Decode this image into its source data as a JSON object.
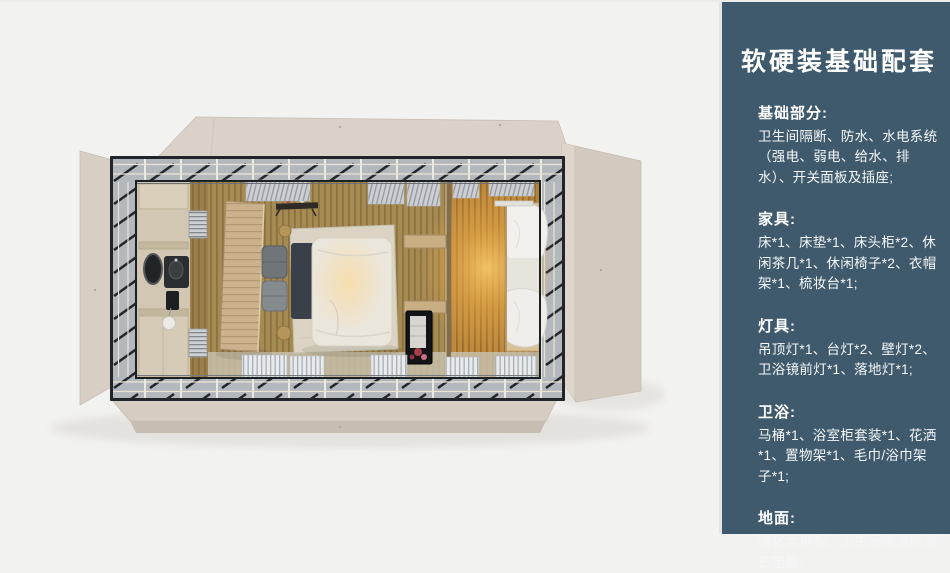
{
  "panel": {
    "title": "软硬装基础配套",
    "sections": [
      {
        "heading": "基础部分:",
        "body": "卫生间隔断、防水、水电系统（强电、弱电、给水、排水）、开关面板及插座;"
      },
      {
        "heading": "家具:",
        "body": "床*1、床垫*1、床头柜*2、休闲茶几*1、休闲椅子*2、衣帽架*1、梳妆台*1;"
      },
      {
        "heading": "灯具:",
        "body": "吊顶灯*1、台灯*2、壁灯*2、卫浴镜前灯*1、落地灯*1;"
      },
      {
        "heading": "卫浴:",
        "body": "马桶*1、浴室柜套装*1、花洒*1、置物架*1、毛巾/浴巾架子*1;"
      },
      {
        "heading": "地面:",
        "body": "强化木地板、卫生间防滑防潮石塑板;"
      }
    ]
  },
  "colors": {
    "panel_background": "#3f5a6c",
    "panel_text": "#ffffff",
    "canvas_background": "#f2f2f0",
    "roof_beige": "#d8d0c6",
    "frame_dark": "#212529",
    "glass_band": "#b3b8bc",
    "floor_wood": "#a58a52",
    "floor_warm_glow": "#eaaa47",
    "bathroom_beige": "#d2c7b2"
  }
}
